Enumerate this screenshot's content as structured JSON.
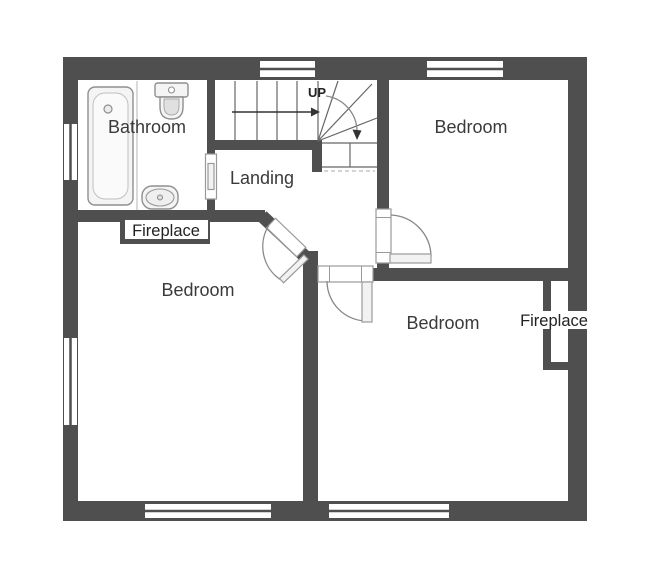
{
  "plan": {
    "labels": {
      "bathroom": "Bathroom",
      "landing": "Landing",
      "bedroom_top_right": "Bedroom",
      "bedroom_left": "Bedroom",
      "bedroom_bottom": "Bedroom",
      "fireplace_left": "Fireplace",
      "fireplace_right": "Fireplace",
      "stairs_up": "UP"
    },
    "colors": {
      "wall": "#4f4f4f",
      "background": "#ffffff",
      "fixture_fill": "#f4f4f4",
      "text": "#3a3a3a"
    },
    "icons": {
      "bathtub": "bathtub-icon",
      "toilet": "toilet-icon",
      "sink": "sink-icon"
    },
    "features": {
      "windows": 6,
      "doors": 5,
      "stair_type": "quarter-turn winder"
    }
  }
}
